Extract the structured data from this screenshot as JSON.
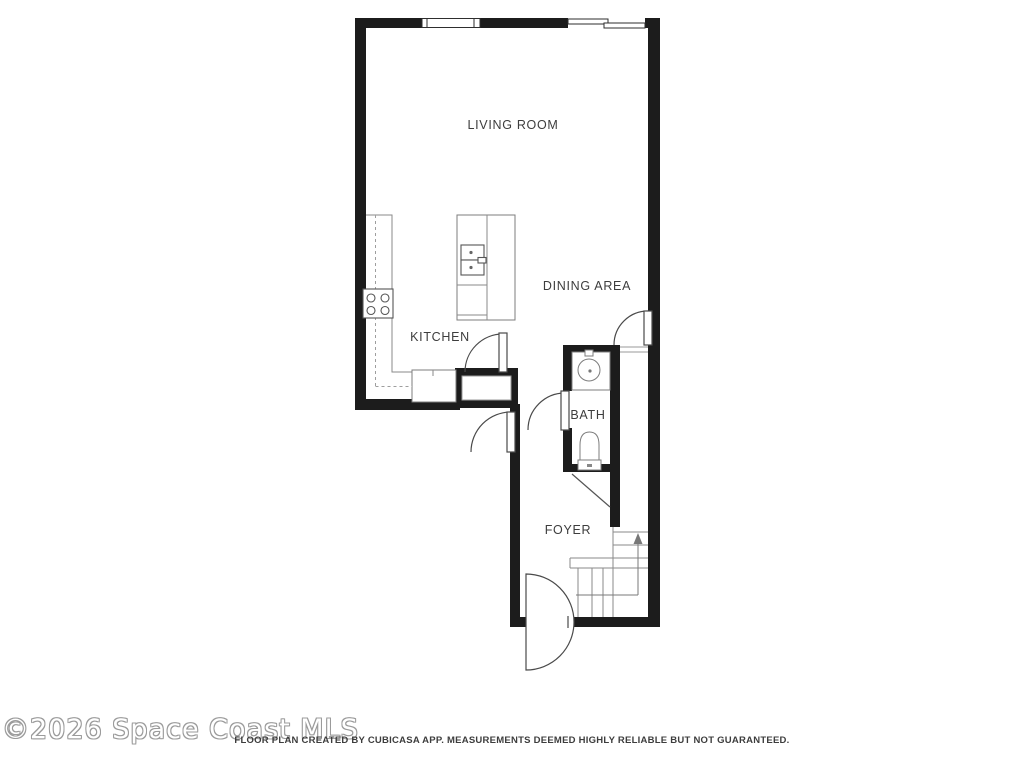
{
  "floor_plan": {
    "labels": {
      "living_room": "LIVING ROOM",
      "dining_area": "DINING AREA",
      "kitchen": "KITCHEN",
      "bath": "BATH",
      "foyer": "FOYER"
    }
  },
  "watermark": {
    "text": "©2026 Space Coast MLS"
  },
  "footer": {
    "disclaimer": "FLOOR PLAN CREATED BY CUBICASA APP. MEASUREMENTS DEEMED HIGHLY RELIABLE BUT NOT GUARANTEED."
  },
  "colors": {
    "background": "#ffffff",
    "wall": "#1c1c1c",
    "fixture_line": "#8a8a8a",
    "door_line": "#4a4a4a",
    "label_text": "#3d3d3d",
    "watermark_outline": "#9b9b9b"
  }
}
